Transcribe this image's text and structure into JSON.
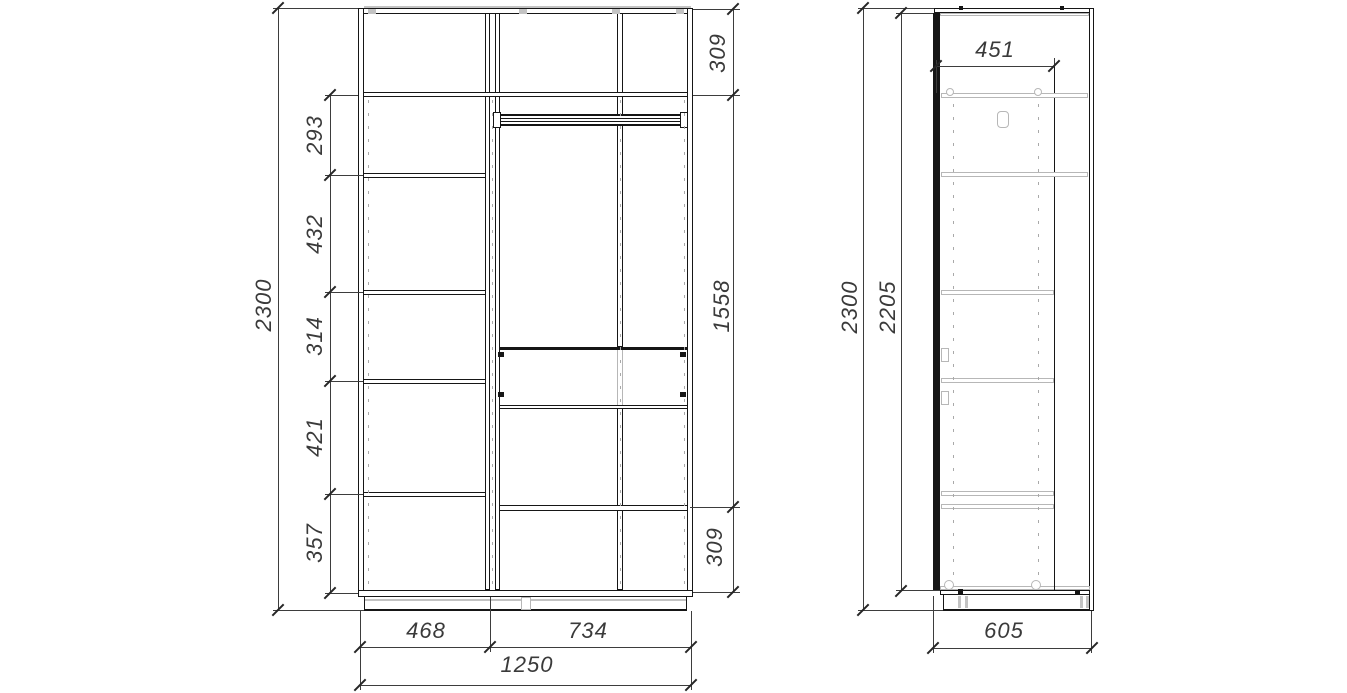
{
  "front_view": {
    "overall_height": "2300",
    "shelf_spacings": [
      "293",
      "432",
      "314",
      "421",
      "357"
    ],
    "top_section_height": "309",
    "hanging_section_height": "1558",
    "bottom_section_height": "309",
    "left_column_width": "468",
    "right_section_width": "734",
    "overall_width": "1250"
  },
  "side_view": {
    "overall_height": "2300",
    "door_height": "2205",
    "interior_depth": "451",
    "overall_depth": "605"
  }
}
